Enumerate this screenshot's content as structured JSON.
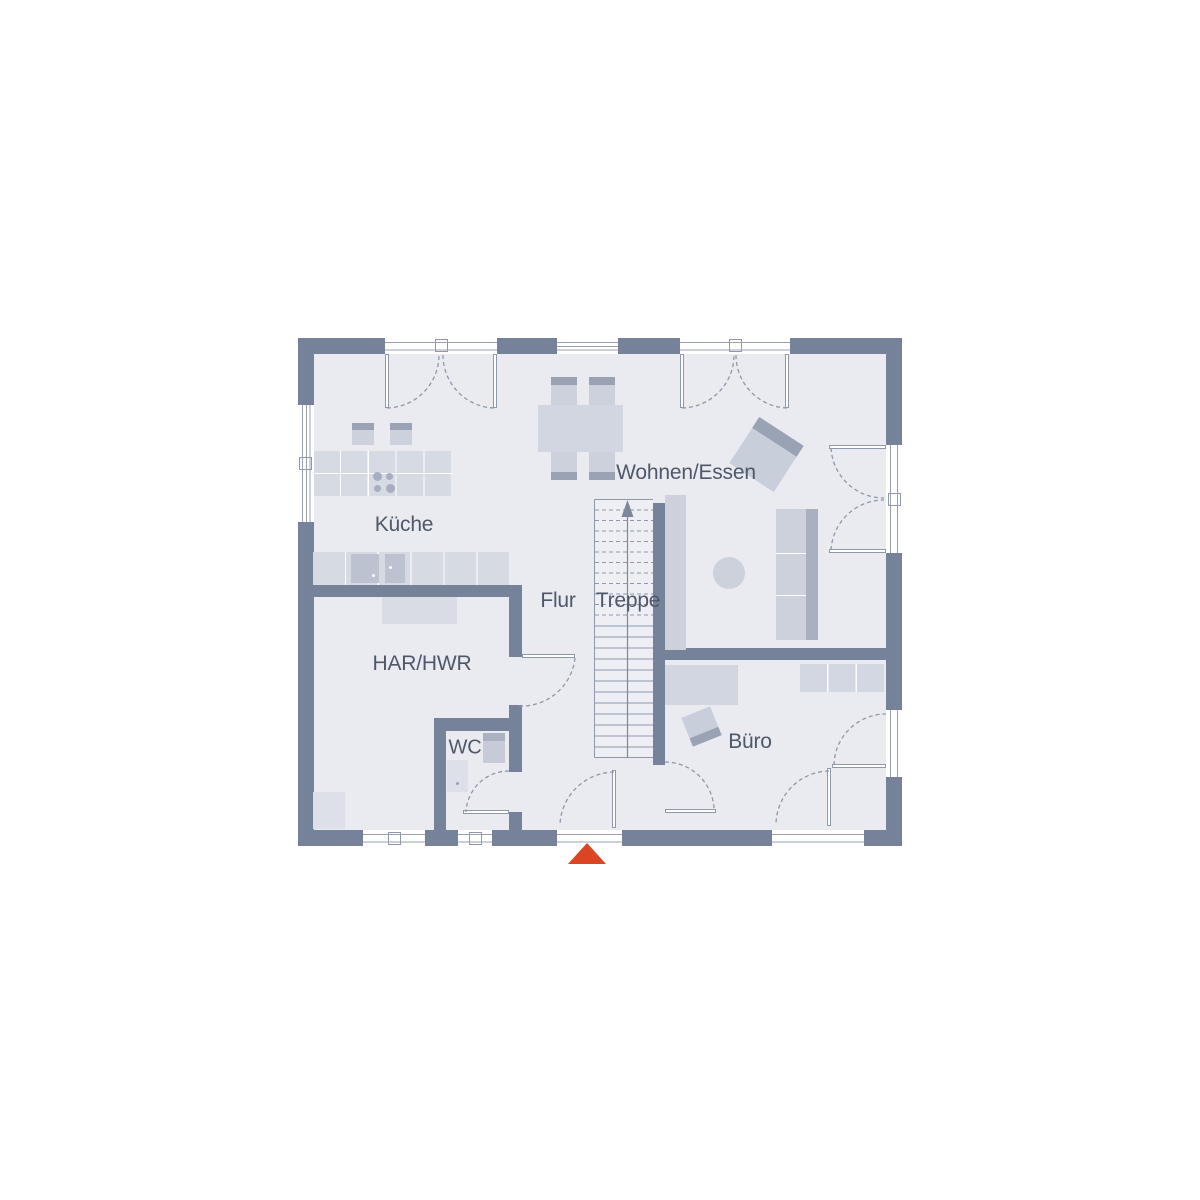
{
  "diagram": {
    "type": "floor-plan",
    "floor_name": "ground-floor"
  },
  "rooms": {
    "kueche": {
      "label": "Küche"
    },
    "wohnen_essen": {
      "label": "Wohnen/Essen"
    },
    "flur": {
      "label": "Flur"
    },
    "treppe": {
      "label": "Treppe"
    },
    "har_hwr": {
      "label": "HAR/HWR"
    },
    "wc": {
      "label": "WC"
    },
    "buero": {
      "label": "Büro"
    }
  },
  "stairs": {
    "direction": "up",
    "dashed_treads": 11,
    "solid_treads": 12
  },
  "colors": {
    "wall": "#76819a",
    "floor": "#e9ebf1",
    "furniture_light": "#d9dce5",
    "furniture_mid": "#ccd1db",
    "furniture_dark": "#9aa3b4",
    "line": "#8f98a9",
    "label_text": "#4f5868",
    "entrance_marker": "#dc4523"
  }
}
